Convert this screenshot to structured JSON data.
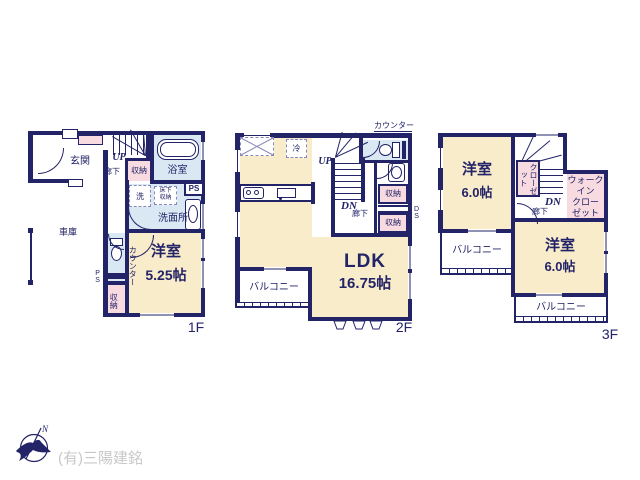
{
  "plan_colors": {
    "wall": "#232368",
    "room_yellow": "#f8ecca",
    "room_pink": "#f8dbe0",
    "room_blue": "#d9e8f3"
  },
  "f1": {
    "floor_label": "1F",
    "entrance": "玄関",
    "up": "UP",
    "hallway": "廊下",
    "closet_top": "収納",
    "bath": "浴室",
    "ps_top": "PS",
    "washer": "洗",
    "underfloor_storage": "床下\n収納",
    "washroom": "洗面所",
    "garage": "車庫",
    "ps_side": "PS",
    "counter": "カウンター",
    "room": "洋室",
    "room_size": "5.25帖",
    "closet_bottom": "収納"
  },
  "f2": {
    "floor_label": "2F",
    "counter_note": "カウンター",
    "fridge": "冷",
    "up": "UP",
    "dn": "DN",
    "hallway": "廊下",
    "closet_a": "収納",
    "closet_b": "収納",
    "ds": "DS",
    "ldk": "LDK",
    "ldk_size": "16.75帖",
    "balcony": "バルコニー"
  },
  "f3": {
    "floor_label": "3F",
    "room_a": "洋室",
    "room_a_size": "6.0帖",
    "closet": "クローゼット",
    "dn": "DN",
    "hallway": "廊下",
    "wic": "ウォーク\nイン\nクロー\nゼット",
    "balcony_a": "バルコニー",
    "room_b": "洋室",
    "room_b_size": "6.0帖",
    "balcony_b": "バルコニー"
  },
  "footer": {
    "company": "(有)三陽建銘",
    "compass_north": "N"
  }
}
